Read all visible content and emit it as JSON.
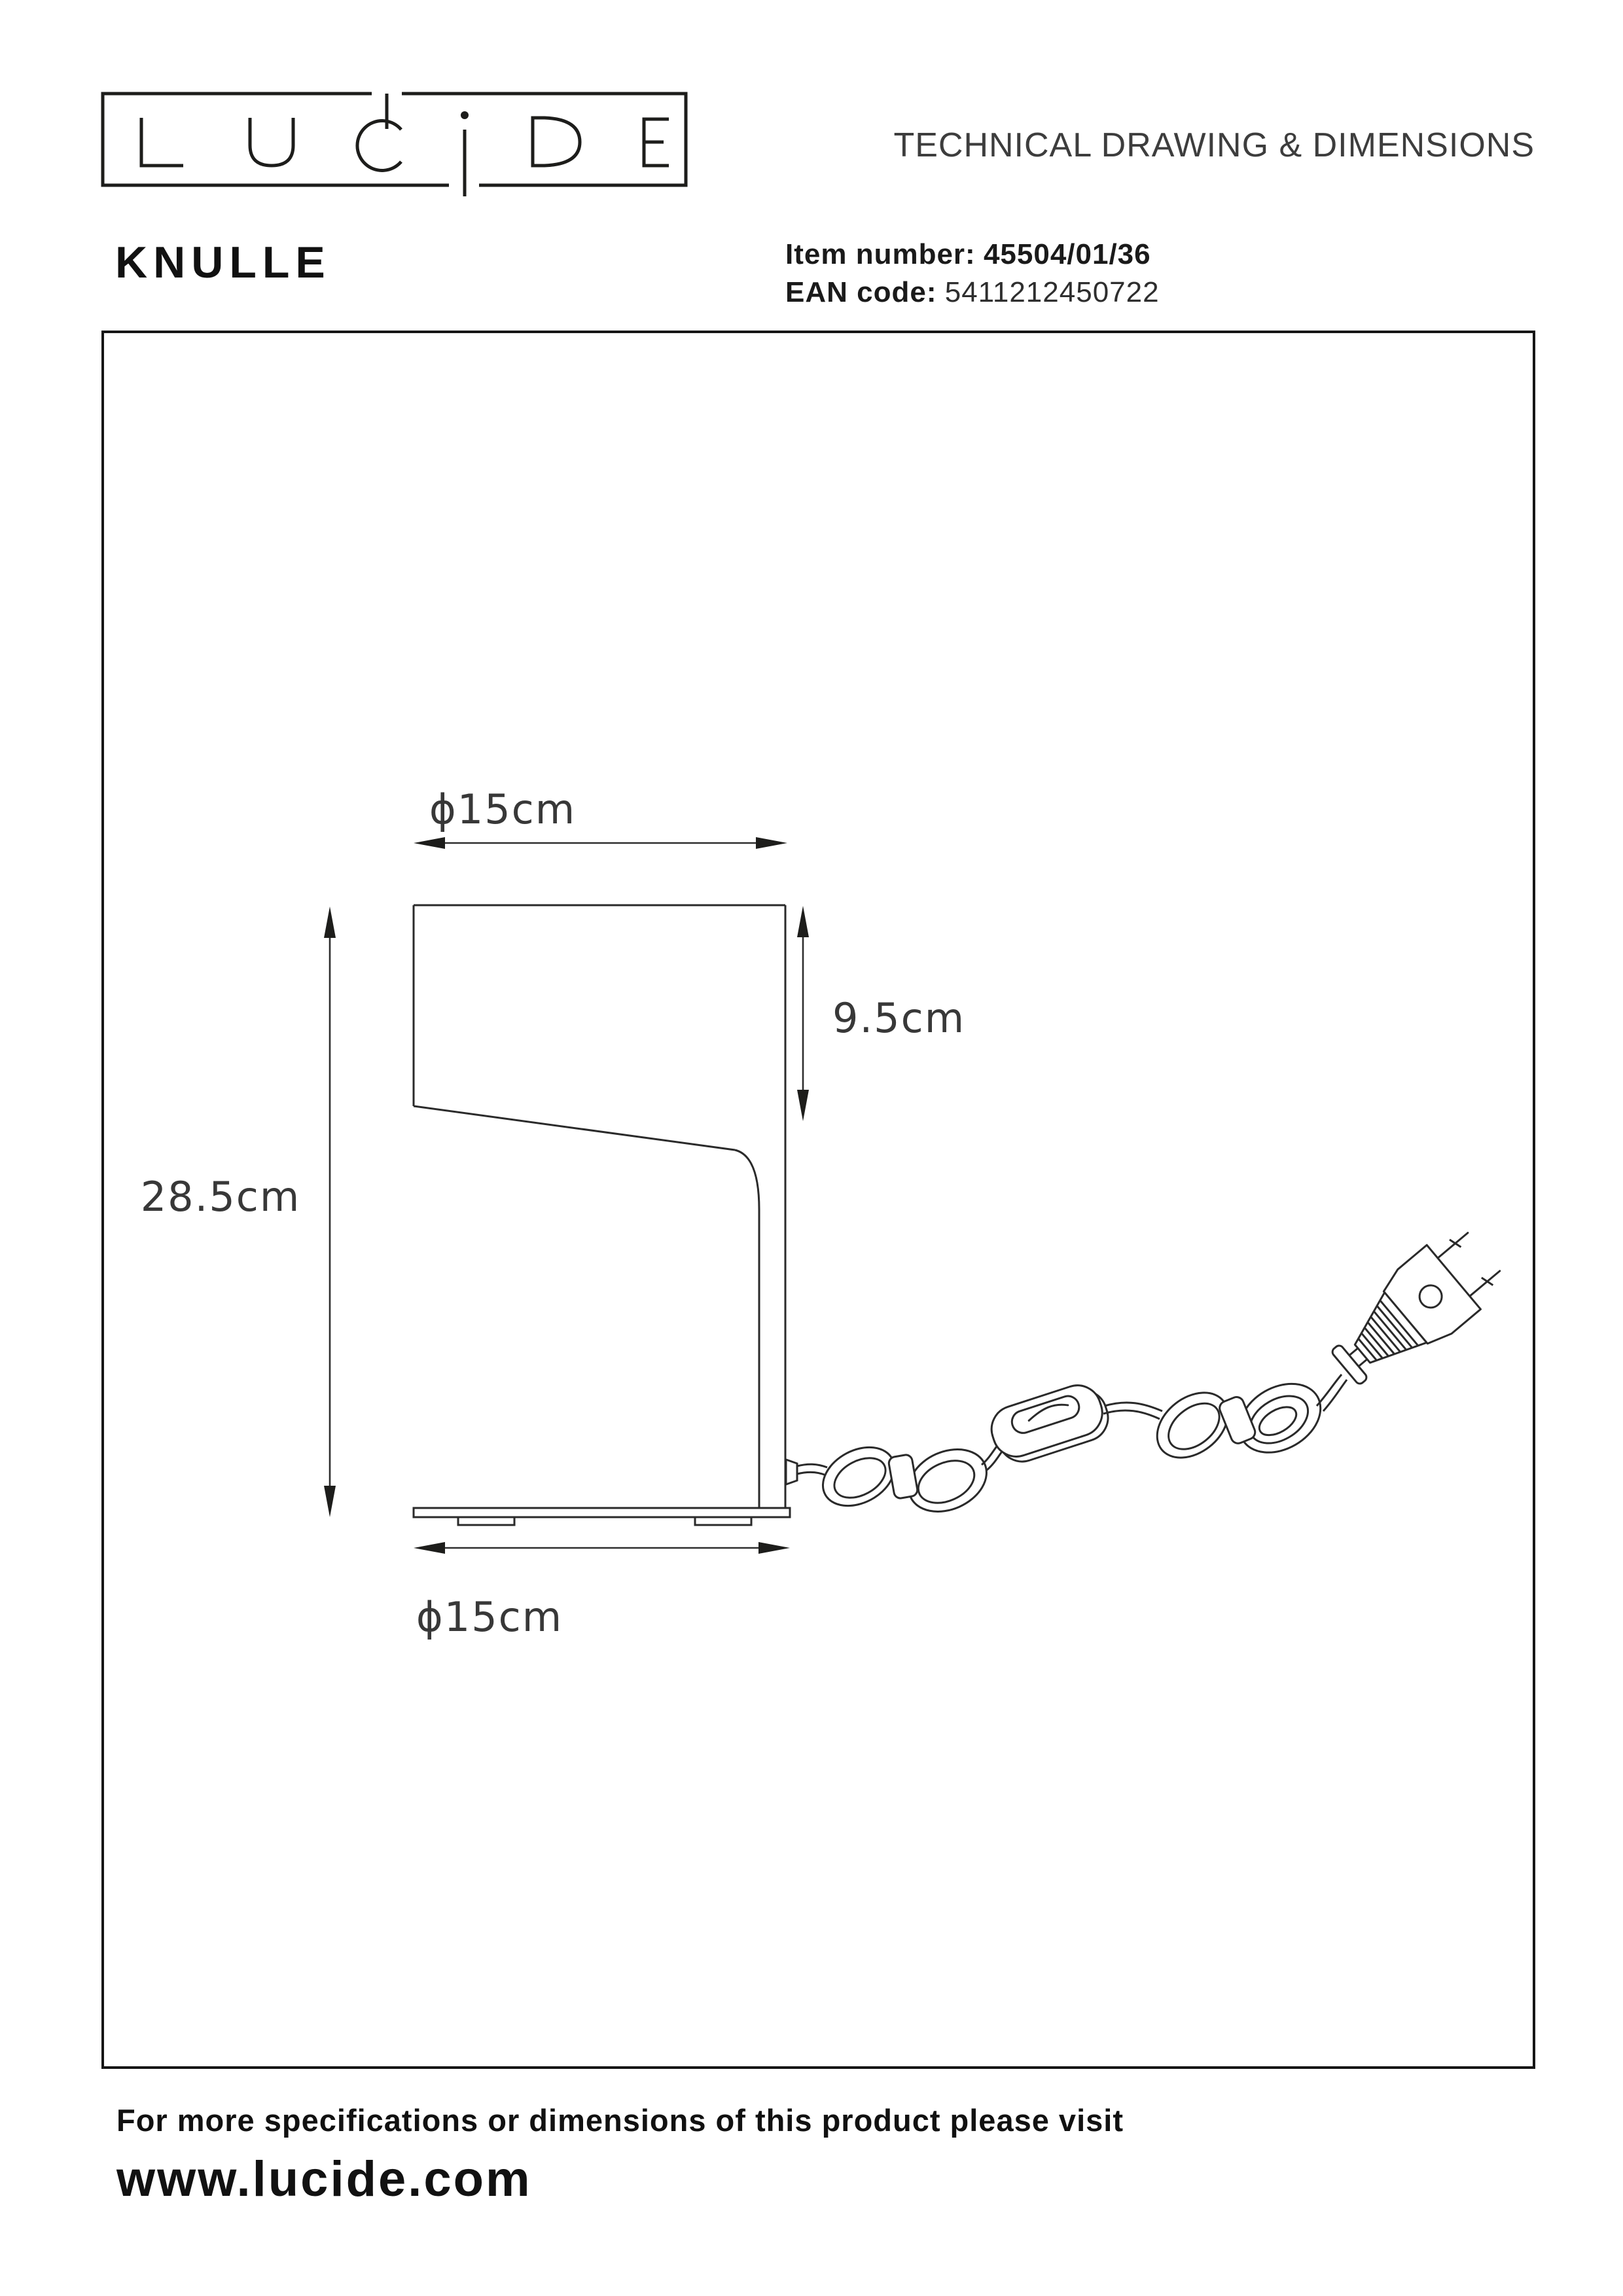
{
  "header": {
    "logo_name": "LUCIDE",
    "title": "TECHNICAL DRAWING & DIMENSIONS",
    "product_name": "KNULLE",
    "item_number_label": "Item number:",
    "item_number_value": "45504/01/36",
    "ean_label": "EAN code:",
    "ean_value": "5411212450722"
  },
  "drawing": {
    "dim_diameter_top": "ϕ15cm",
    "dim_shade_height": "9.5cm",
    "dim_total_height": "28.5cm",
    "dim_diameter_base": "ϕ15cm"
  },
  "footer": {
    "line1": "For more specifications or dimensions of this product please visit",
    "line2": "www.lucide.com"
  },
  "colors": {
    "ink": "#2a2a2a",
    "text": "#1d1d1b",
    "background": "#ffffff"
  }
}
